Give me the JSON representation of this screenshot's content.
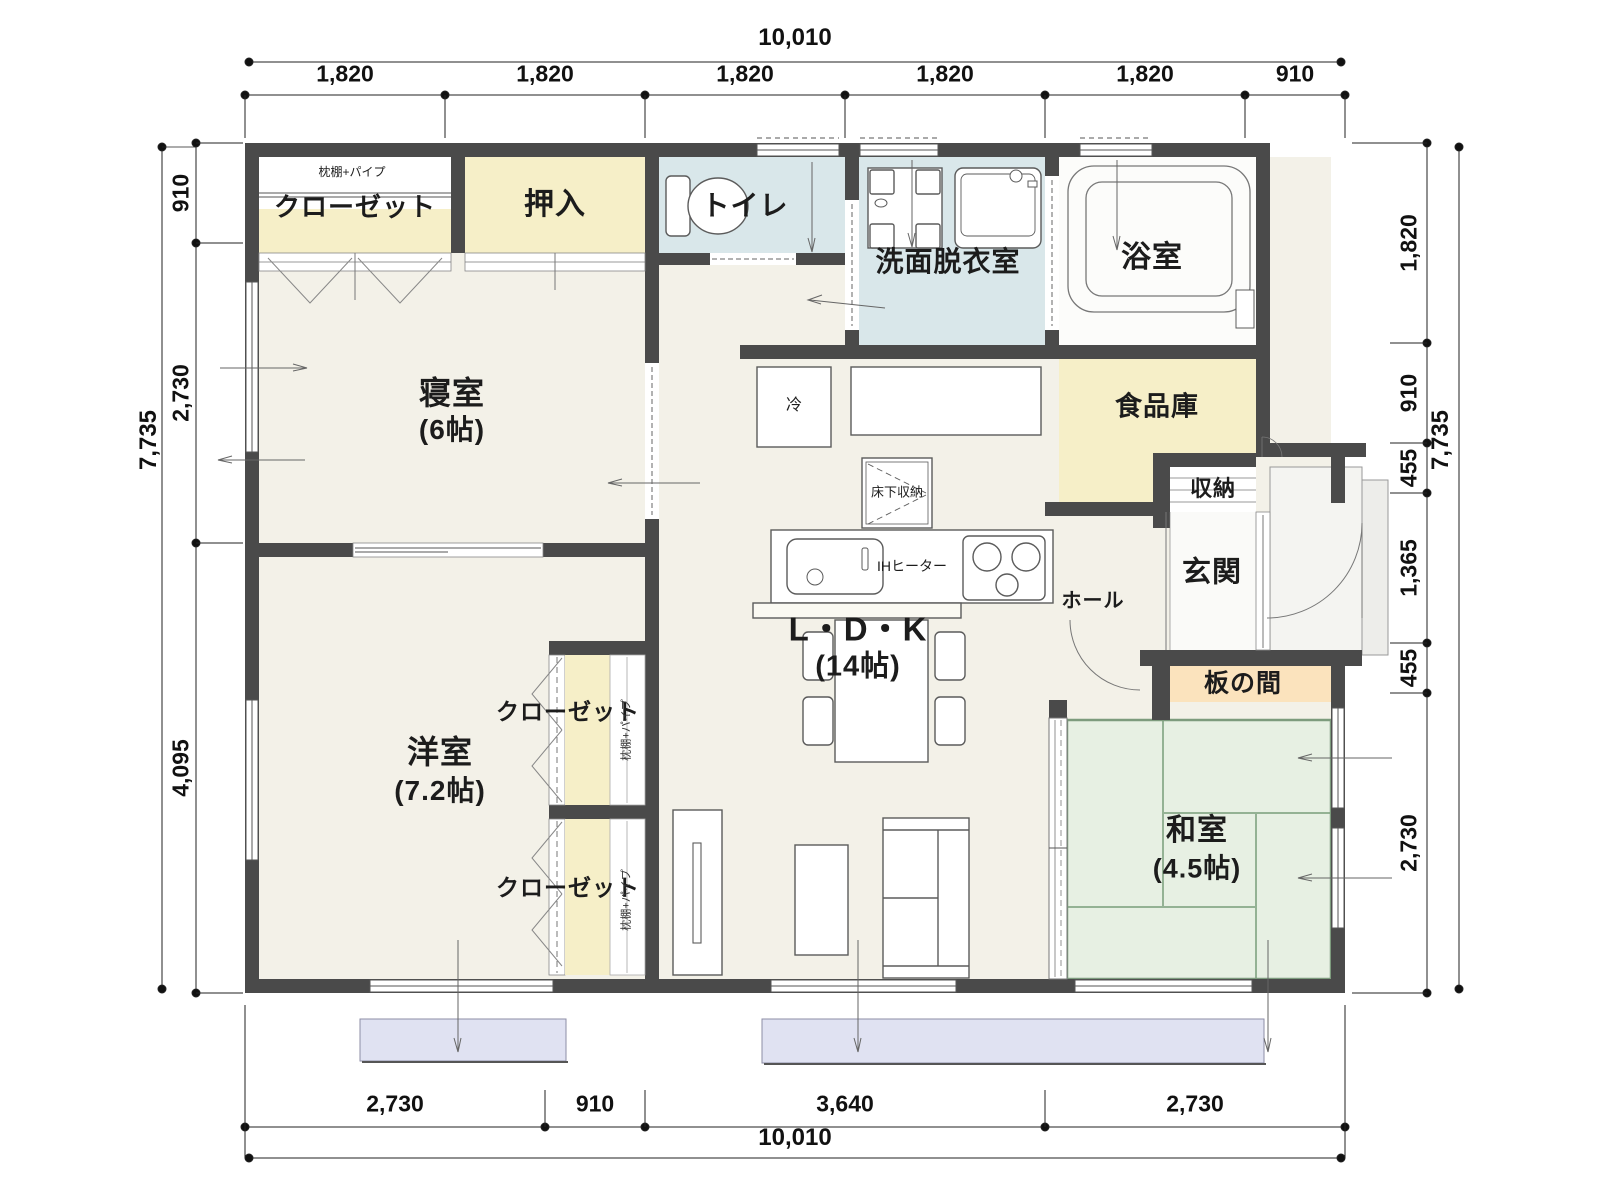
{
  "rooms": {
    "closet_nw": {
      "label": "クローゼット",
      "note": "枕棚+パイプ"
    },
    "oshiire": {
      "label": "押入"
    },
    "toilet": {
      "label": "トイレ"
    },
    "washroom": {
      "label": "洗面脱衣室"
    },
    "bathroom": {
      "label": "浴室"
    },
    "bedroom": {
      "label": "寝室",
      "size": "(6帖)"
    },
    "pantry": {
      "label": "食品庫"
    },
    "storage": {
      "label": "収納"
    },
    "entrance": {
      "label": "玄関"
    },
    "hall": {
      "label": "ホール"
    },
    "itanoma": {
      "label": "板の間"
    },
    "washitsu": {
      "label": "和室",
      "size": "(4.5帖)"
    },
    "ldk": {
      "label": "L・D・K",
      "size": "(14帖)"
    },
    "youshitsu": {
      "label": "洋室",
      "size": "(7.2帖)"
    },
    "closet_mid": {
      "label": "クローゼット",
      "note": "枕棚+パイプ"
    },
    "closet_south": {
      "label": "クローゼット",
      "note": "枕棚+パイプ"
    }
  },
  "fixtures": {
    "refrigerator": "冷",
    "underfloor_storage": "床下収納",
    "ih_heater": "IHヒーター"
  },
  "dimensions": {
    "top": {
      "total": "10,010",
      "segments": [
        "1,820",
        "1,820",
        "1,820",
        "1,820",
        "1,820",
        "910"
      ]
    },
    "bottom": {
      "total": "10,010",
      "segments": [
        "2,730",
        "910",
        "3,640",
        "2,730"
      ]
    },
    "left": {
      "total": "7,735",
      "segments": [
        "910",
        "2,730",
        "4,095"
      ]
    },
    "right": {
      "total": "7,735",
      "segments": [
        "1,820",
        "910",
        "455",
        "1,365",
        "455",
        "2,730"
      ]
    }
  },
  "colors": {
    "wall": "#4a4a4a",
    "floor": "#f3f1e8",
    "closet": "#f6efc8",
    "wet_area": "#d9e7ea",
    "tatami": "#e7f0e3",
    "itanoma": "#fbe3bd",
    "deck": "#e0e2f2"
  }
}
